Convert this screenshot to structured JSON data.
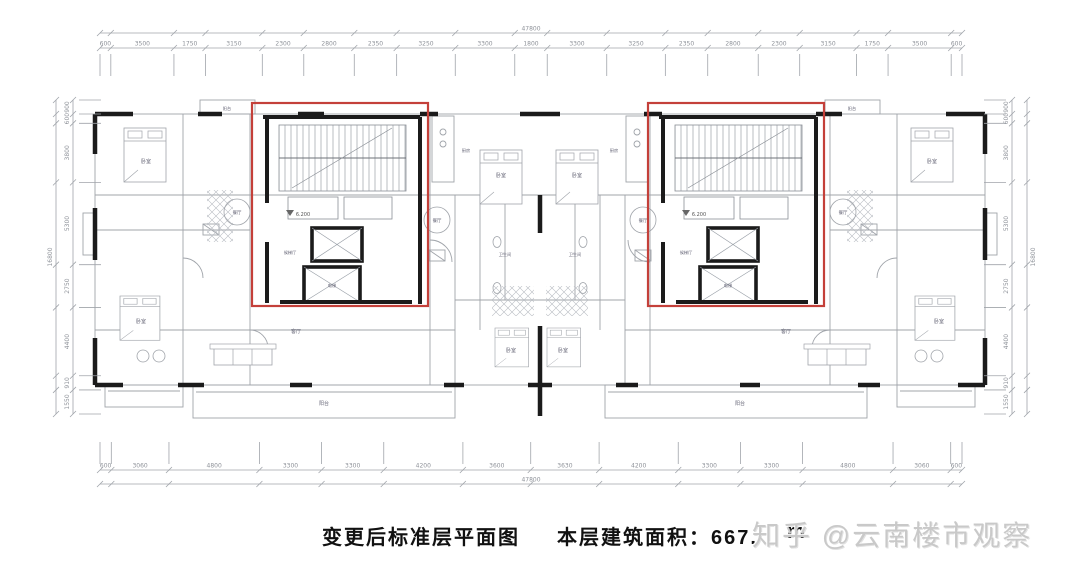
{
  "caption": {
    "plan_name": "变更后标准层平面图",
    "area_text": "本层建筑面积：667.",
    "area_tail": "m"
  },
  "watermark": {
    "text": "知乎 @云南楼市观察"
  },
  "colors": {
    "highlight_red": "#c4403a",
    "wall": "#1b1b1b",
    "line": "#a0a4aa",
    "dim_text": "#8e9299"
  },
  "dimensions": {
    "top": {
      "total": "47800",
      "segments": [
        "600",
        "3500",
        "1750",
        "3150",
        "2300",
        "2800",
        "2350",
        "3250",
        "3300",
        "1800",
        "3300",
        "3250",
        "2350",
        "2800",
        "2300",
        "3150",
        "1750",
        "3500",
        "600"
      ]
    },
    "bottom": {
      "total": "47800",
      "segments": [
        "600",
        "3060",
        "4800",
        "3300",
        "3300",
        "4200",
        "3600",
        "3630",
        "4200",
        "3300",
        "3300",
        "4800",
        "3060",
        "600"
      ]
    },
    "left": {
      "total": "16800",
      "segments": [
        "900",
        "600",
        "3800",
        "5300",
        "2750",
        "4400",
        "910",
        "1550"
      ]
    },
    "right": {
      "total": "16800",
      "segments": [
        "900",
        "600",
        "3800",
        "5300",
        "2750",
        "4400",
        "910",
        "1550"
      ]
    }
  },
  "rooms": {
    "bedroom": "卧室",
    "living": "客厅",
    "dining": "餐厅",
    "balcony": "阳台",
    "kitchen": "厨房",
    "bath": "卫生间",
    "elevator": "电梯",
    "lobby": "候梯厅",
    "level": "6.200"
  }
}
